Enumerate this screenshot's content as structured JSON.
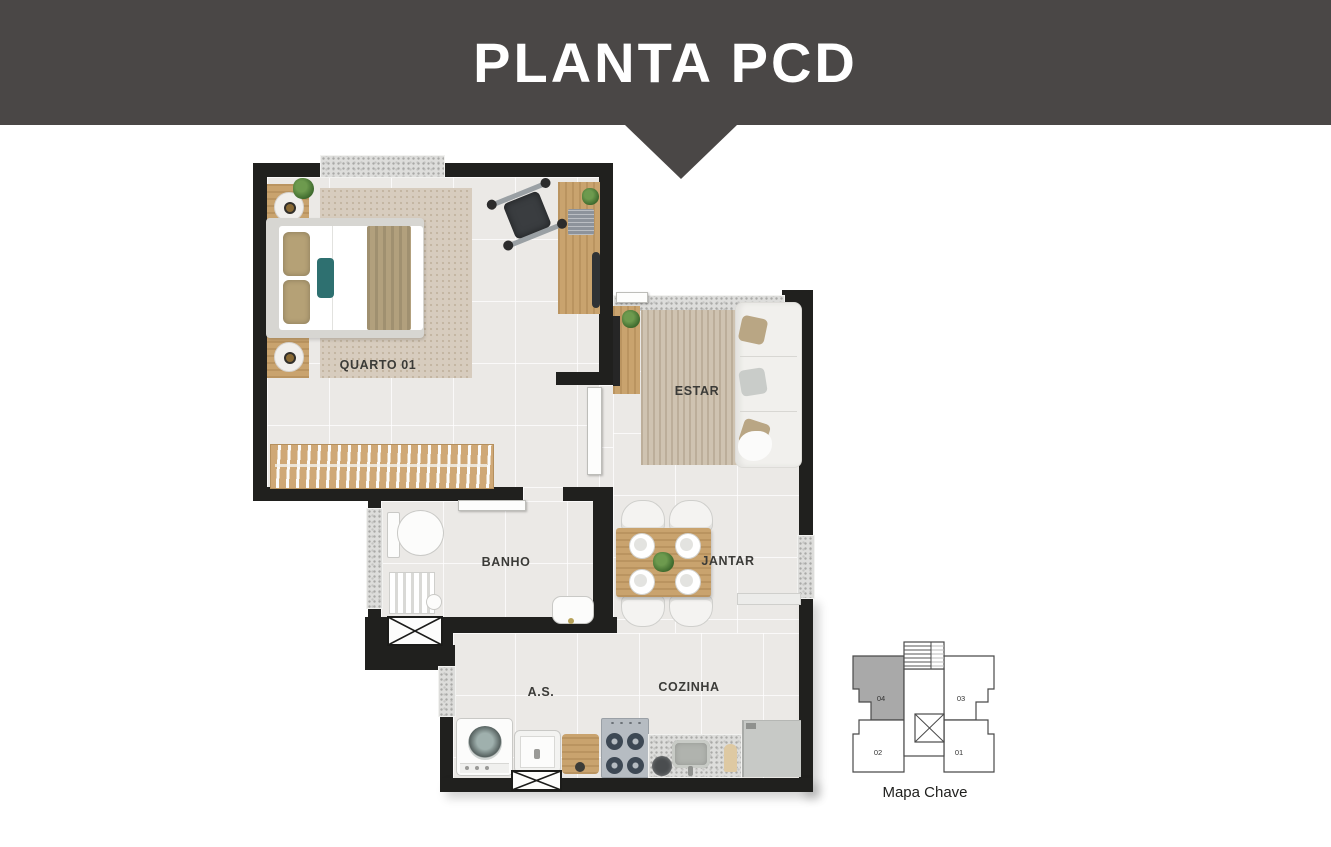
{
  "header": {
    "title": "PLANTA PCD"
  },
  "floorplan": {
    "rooms": [
      {
        "name": "quarto-01",
        "label": "QUARTO 01"
      },
      {
        "name": "estar",
        "label": "ESTAR"
      },
      {
        "name": "banho",
        "label": "BANHO"
      },
      {
        "name": "jantar",
        "label": "JANTAR"
      },
      {
        "name": "area-servico",
        "label": "A.S."
      },
      {
        "name": "cozinha",
        "label": "COZINHA"
      }
    ],
    "furniture": {
      "quarto-01": [
        "double-bed",
        "nightstand-with-lamp",
        "nightstand-with-lamp",
        "area-rug",
        "desk",
        "laptop",
        "wheelchair",
        "closet-rack-with-hangers",
        "plant"
      ],
      "estar": [
        "tv-console",
        "tv",
        "plant",
        "area-rug",
        "sofa-with-pillows"
      ],
      "banho": [
        "toilet",
        "shower-seat",
        "sink",
        "shower-shaft"
      ],
      "jantar": [
        "dining-table",
        "chair",
        "chair",
        "chair",
        "chair",
        "plates",
        "plant-centerpiece",
        "bench"
      ],
      "area-servico": [
        "washing-machine",
        "laundry-tank"
      ],
      "cozinha": [
        "cutting-board",
        "stove-cooktop",
        "counter-with-sink",
        "pot",
        "fridge"
      ]
    }
  },
  "key_map": {
    "caption": "Mapa Chave",
    "highlighted_unit": "04",
    "units": [
      {
        "label": "04",
        "highlighted": true
      },
      {
        "label": "03",
        "highlighted": false
      },
      {
        "label": "02",
        "highlighted": false
      },
      {
        "label": "01",
        "highlighted": false
      }
    ],
    "core": [
      "stairs",
      "elevator"
    ]
  },
  "colors": {
    "banner_bg": "#4a4746",
    "banner_text": "#ffffff",
    "walls": "#20201e",
    "floor": "#ebe9e6",
    "window_granite": "#dddddb",
    "wood": "#c9a36e",
    "accent_teal": "#2e7070",
    "key_map_highlight": "#a9a9a9"
  }
}
